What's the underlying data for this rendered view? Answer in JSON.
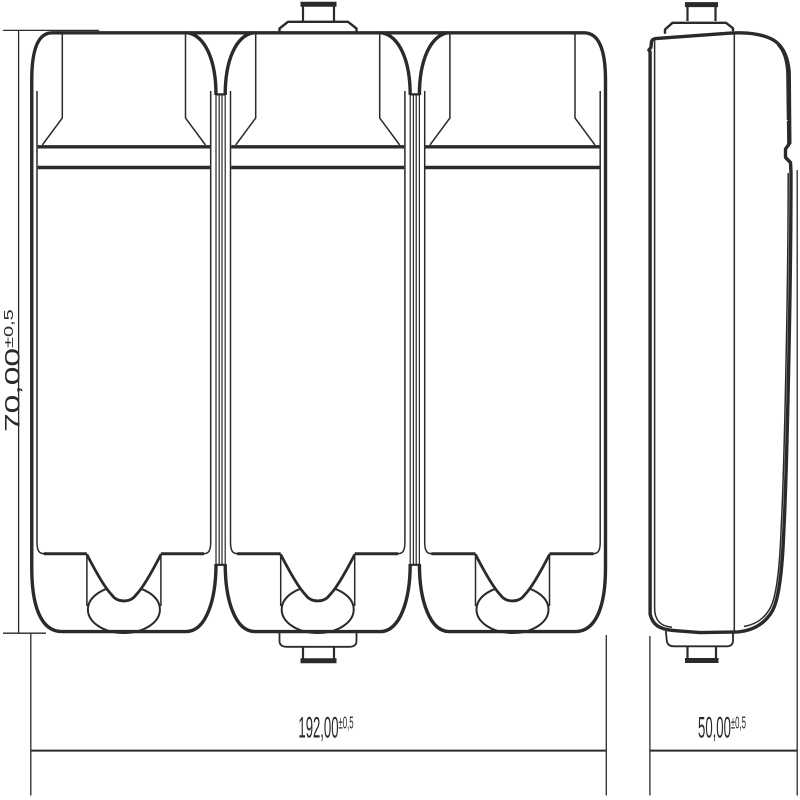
{
  "drawing": {
    "type": "technical-drawing",
    "description": "Three-module battery housing, front view and side view with dimensions",
    "background_color": "#ffffff",
    "line_color": "#2a2a2a",
    "views": {
      "front": {
        "label": "front-view",
        "module_count": 3
      },
      "side": {
        "label": "side-view"
      }
    },
    "dimensions": {
      "width": {
        "value": "192,00",
        "tolerance": "±0,5"
      },
      "depth": {
        "value": "50,00",
        "tolerance": "±0,5"
      },
      "height": {
        "value": "70,00",
        "tolerance": "±0,5"
      }
    }
  }
}
